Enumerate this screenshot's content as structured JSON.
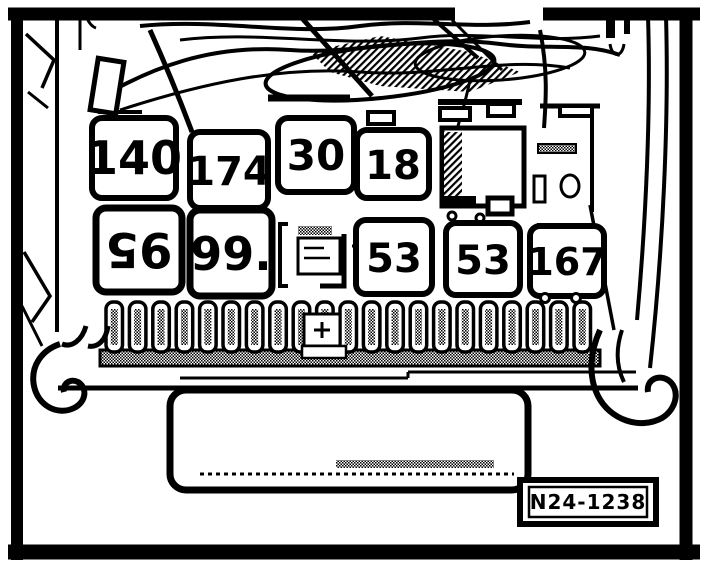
{
  "figure": {
    "code": "N24-1238",
    "description": "Relay panel and fuse carrier line-art service diagram",
    "colors": {
      "ink": "#000000",
      "paper": "#ffffff"
    }
  },
  "relay_rows": {
    "row1": [
      {
        "label": "140"
      },
      {
        "label": "174"
      },
      {
        "label": "30"
      },
      {
        "label": "18"
      }
    ],
    "row2": [
      {
        "label": "95",
        "rotated_180": true
      },
      {
        "label": "99."
      },
      {
        "label": "53"
      },
      {
        "label": "53"
      },
      {
        "label": "167"
      }
    ]
  },
  "fuses": {
    "count": 21
  }
}
